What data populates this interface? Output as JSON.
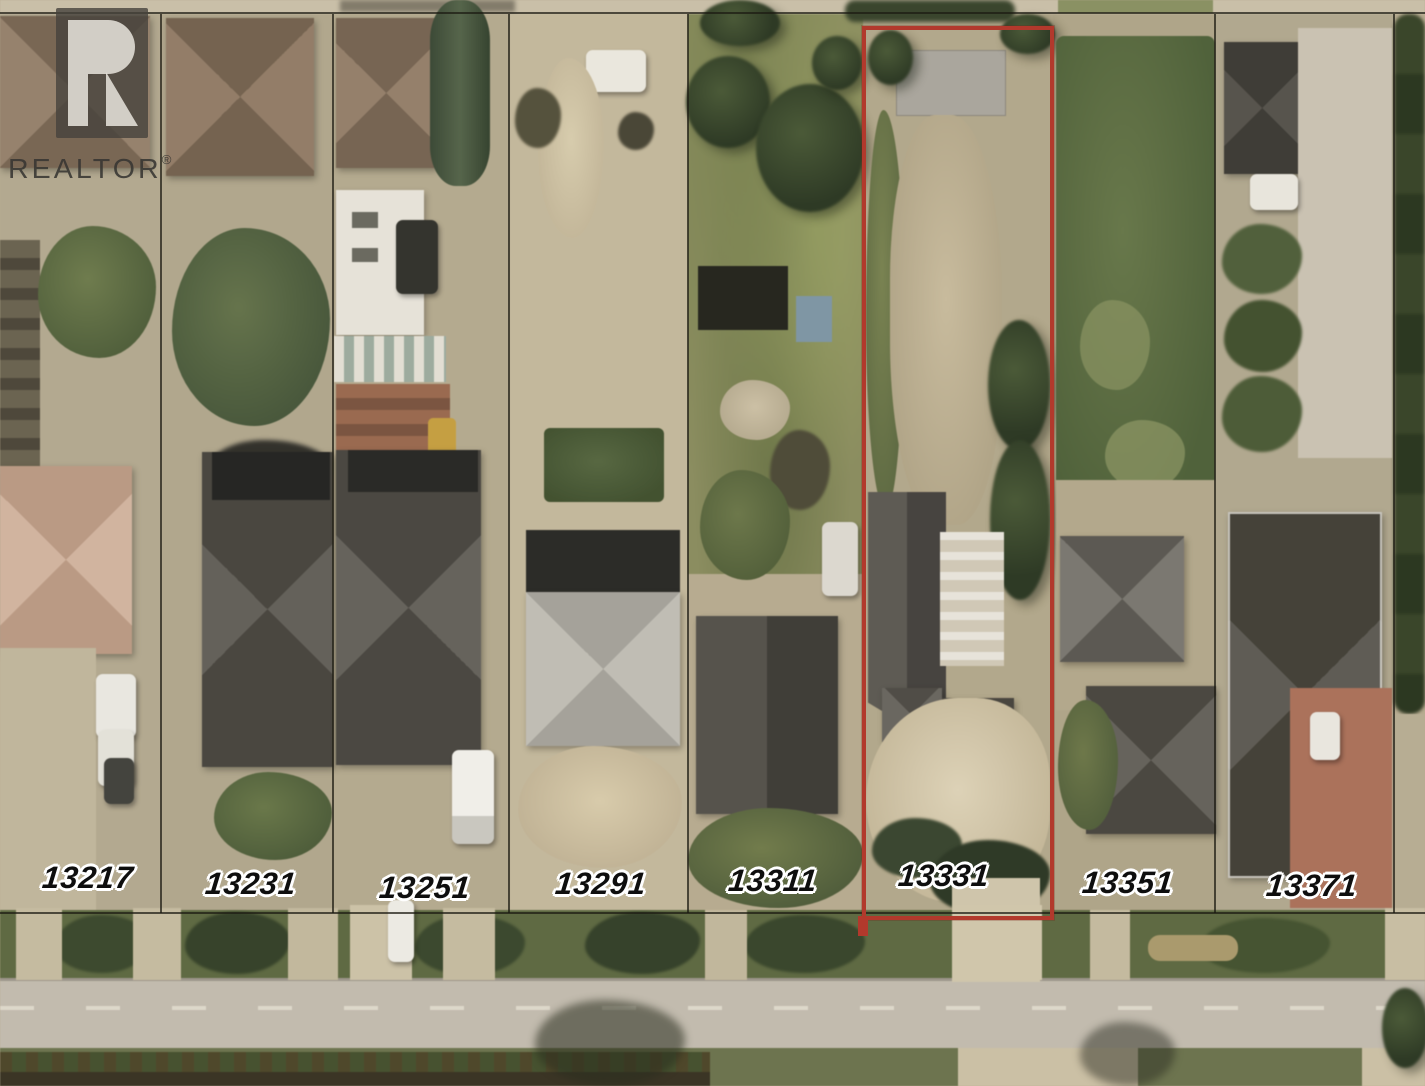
{
  "watermark": {
    "brand": "REALTOR",
    "registered": "®"
  },
  "parcels": [
    {
      "label": "13217",
      "highlighted": false
    },
    {
      "label": "13231",
      "highlighted": false
    },
    {
      "label": "13251",
      "highlighted": false
    },
    {
      "label": "13291",
      "highlighted": false
    },
    {
      "label": "13311",
      "highlighted": false
    },
    {
      "label": "13331",
      "highlighted": true
    },
    {
      "label": "13351",
      "highlighted": false
    },
    {
      "label": "13371",
      "highlighted": false
    }
  ],
  "highlight": {
    "color": "#b2392c",
    "parcel_label": "13331"
  }
}
